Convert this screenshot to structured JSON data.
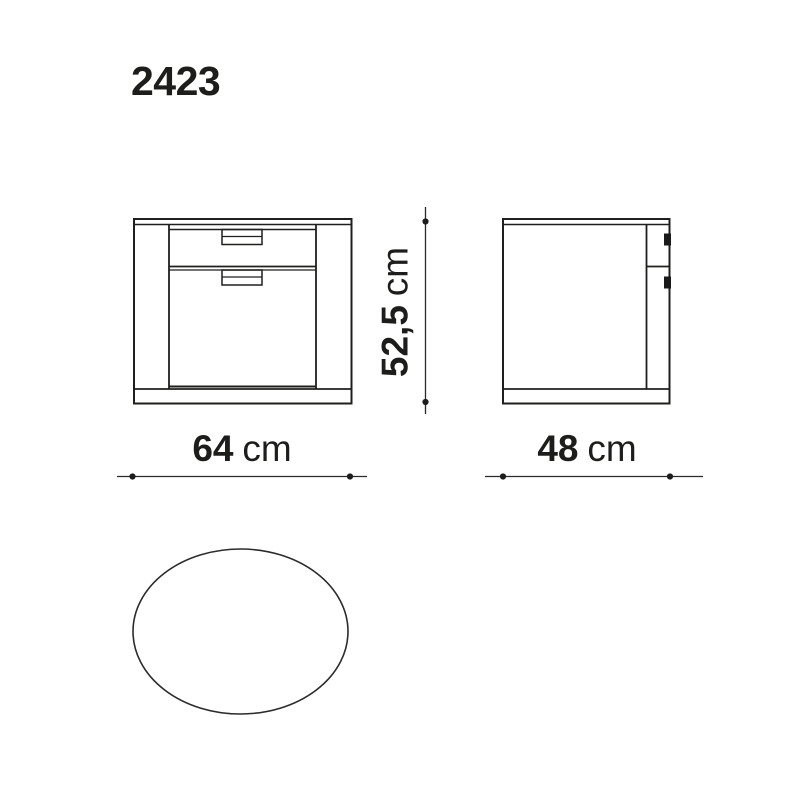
{
  "page": {
    "title": "2423",
    "background": "#ffffff"
  },
  "colors": {
    "drawing_line": "#1f1f1d",
    "dimension_line": "#2a2a2a",
    "text": "#1d1d1b",
    "handle_fill": "#1a1a1a"
  },
  "dimensions": {
    "width": {
      "value": "64",
      "unit": "cm"
    },
    "depth": {
      "value": "48",
      "unit": "cm"
    },
    "height": {
      "value": "52,5",
      "unit": "cm"
    }
  }
}
